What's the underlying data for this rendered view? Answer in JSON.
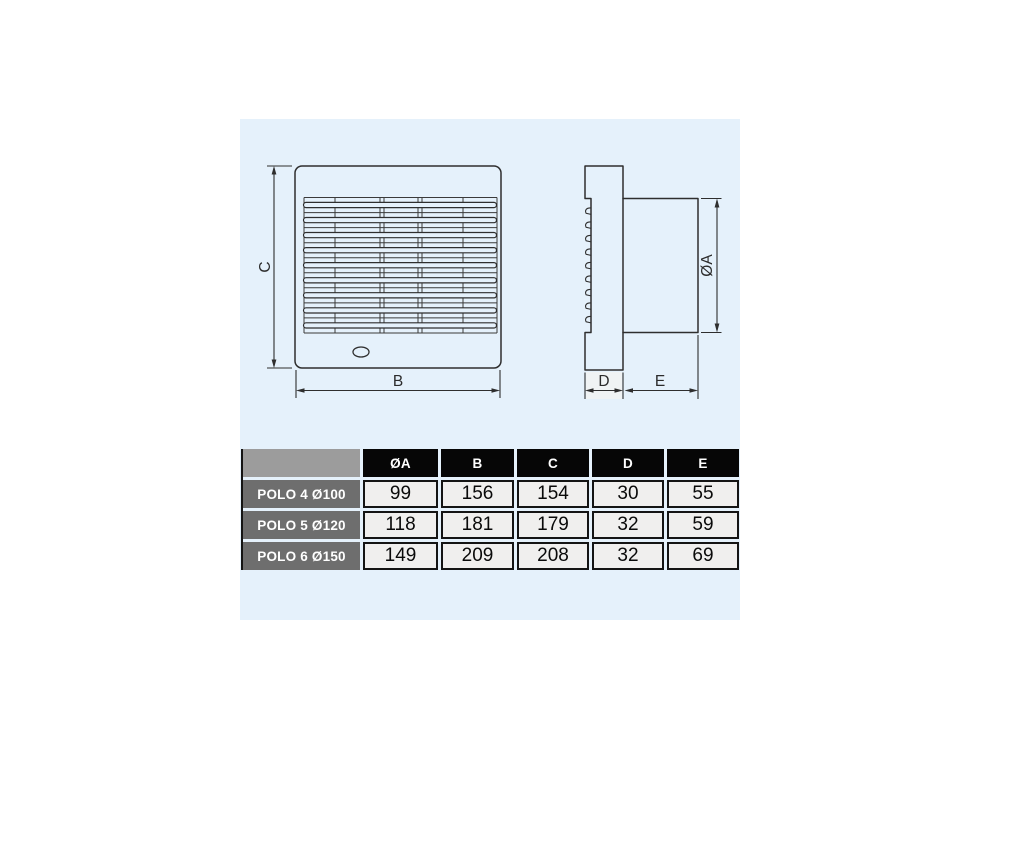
{
  "colors": {
    "panel_background": "#e5f1fb",
    "drawing_line": "#2e2e2e",
    "table_header_bg": "#060606",
    "table_corner_bg": "#9c9c9c",
    "table_row_label_bg": "#6e6e6e",
    "table_value_bg": "#f0efee"
  },
  "diagram": {
    "front_view": {
      "height_label": "C",
      "width_label": "B"
    },
    "side_view": {
      "diameter_label": "ØA",
      "depth_label": "D",
      "duct_length_label": "E"
    }
  },
  "table": {
    "columns": [
      "ØA",
      "B",
      "C",
      "D",
      "E"
    ],
    "rows": [
      {
        "model": "POLO 4 Ø100",
        "values": [
          "99",
          "156",
          "154",
          "30",
          "55"
        ]
      },
      {
        "model": "POLO 5 Ø120",
        "values": [
          "118",
          "181",
          "179",
          "32",
          "59"
        ]
      },
      {
        "model": "POLO 6 Ø150",
        "values": [
          "149",
          "209",
          "208",
          "32",
          "69"
        ]
      }
    ]
  }
}
